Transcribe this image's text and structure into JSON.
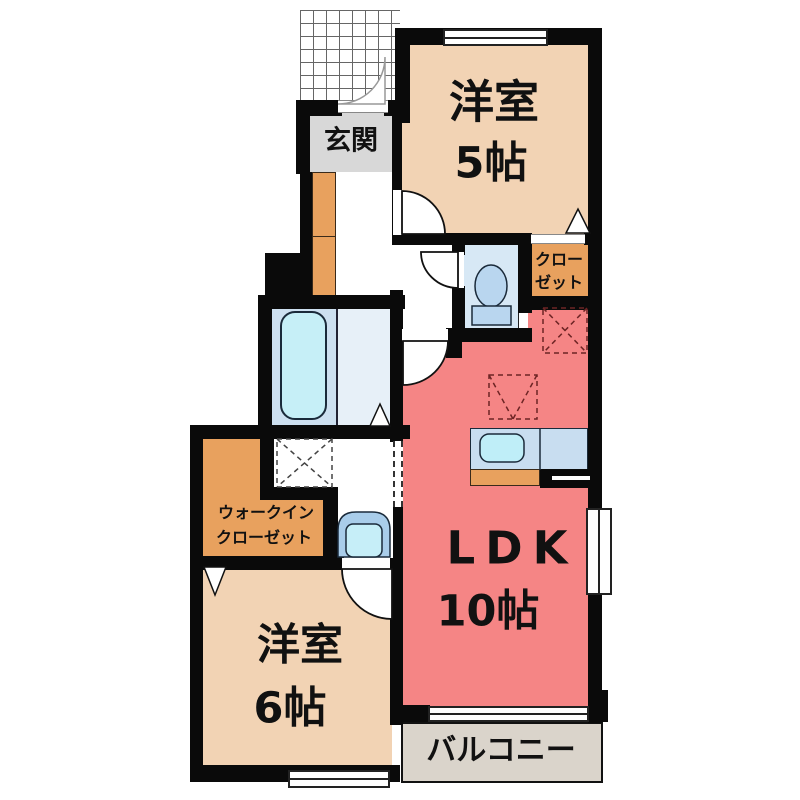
{
  "floorplan": {
    "rooms": {
      "genkan": {
        "label": "玄関"
      },
      "bedroom5": {
        "name": "洋室",
        "size": "5帖"
      },
      "closet": {
        "line1": "クロー",
        "line2": "ゼット"
      },
      "ldk": {
        "name": "LDK",
        "size": "10帖"
      },
      "walk_in_closet": {
        "line1": "ウォークイン",
        "line2": "クローゼット"
      },
      "bedroom6": {
        "name": "洋室",
        "size": "6帖"
      },
      "balcony": {
        "label": "バルコニー"
      }
    },
    "colors": {
      "wall": "#0a0a0a",
      "bedroom_tan": "#f2d3b4",
      "ldk_pink": "#f58585",
      "closet_orange": "#e8a15e",
      "genkan_gray": "#d8d8d8",
      "balcony_beige": "#dad4cb",
      "bathroom_blue": "#cde0f0",
      "toilet_blue": "#d7e8f5",
      "fixture_blue": "#bfeef8"
    },
    "icons": [
      "entrance-porch-hatch",
      "door-swing",
      "bathtub",
      "toilet",
      "washbasin",
      "kitchen-sink",
      "washing-machine-space",
      "refrigerator-space",
      "closet-door-triangle"
    ]
  }
}
